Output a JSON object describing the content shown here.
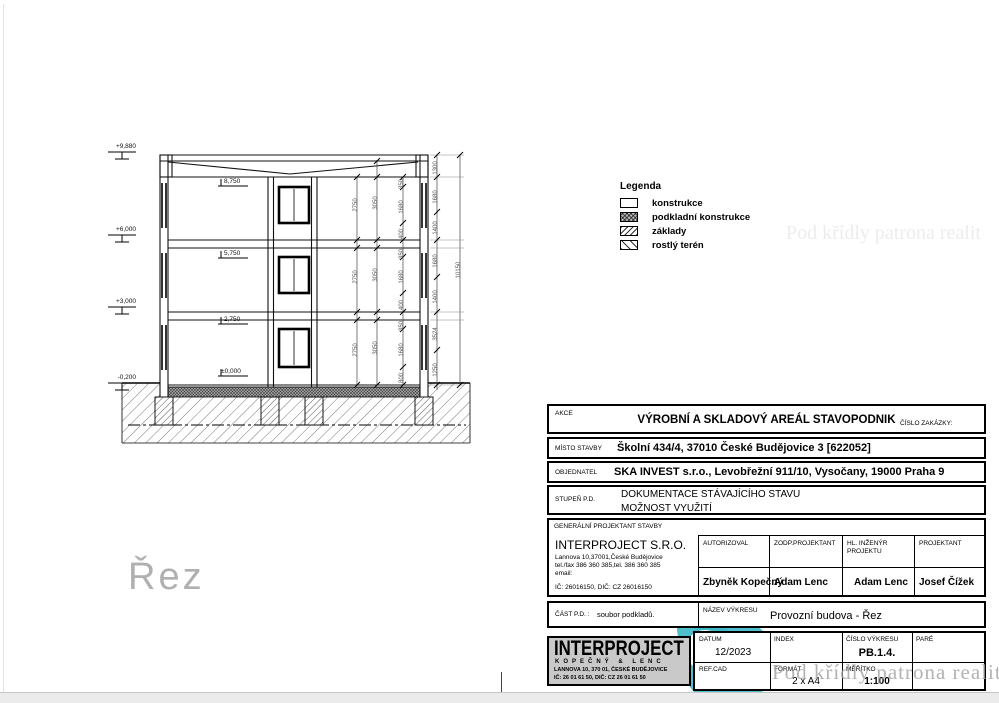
{
  "page": {
    "watermark": "Pod křídly patrona realit",
    "drawing_caption": "Řez"
  },
  "legend": {
    "title": "Legenda",
    "items": [
      {
        "label": "konstrukce"
      },
      {
        "label": "podkladní konstrukce"
      },
      {
        "label": "základy"
      },
      {
        "label": "rostlý terén"
      }
    ]
  },
  "drawing": {
    "levels_outer": [
      "+9,880",
      "+6,000",
      "+3,000",
      "-0,200"
    ],
    "levels_inner": [
      "8,750",
      "5,750",
      "2,750",
      "±0,000"
    ],
    "floor_heights": [
      "2750",
      "2750",
      "2750"
    ],
    "clear_heights": [
      "3050",
      "3050",
      "3050"
    ],
    "window_chain": [
      "350",
      "1680",
      "400",
      "350",
      "1680",
      "400",
      "350",
      "1680",
      "800"
    ],
    "right_chain": [
      "1300",
      "1680",
      "1400",
      "1680",
      "1400",
      "3524",
      "1250"
    ],
    "total_height": "10150"
  },
  "titleblock": {
    "akce_label": "AKCE",
    "akce_value": "VÝROBNÍ A SKLADOVÝ AREÁL STAVOPODNIK",
    "cislo_zakazky_label": "ČÍSLO ZAKÁZKY:",
    "misto_label": "MÍSTO STAVBY",
    "misto_value": "Školní 434/4, 37010 České Budějovice 3 [622052]",
    "objednatel_label": "OBJEDNATEL",
    "objednatel_value": "SKA INVEST s.r.o., Levobřežní 911/10, Vysočany, 19000 Praha 9",
    "stupen_label": "STUPEŇ P.D.",
    "stupen_value_1": "DOKUMENTACE STÁVAJÍCÍHO STAVU",
    "stupen_value_2": "MOŽNOST VYUŽITÍ",
    "gen_projektant_label": "GENERÁLNÍ PROJEKTANT STAVBY",
    "company": {
      "name": "INTERPROJECT S.R.O.",
      "address": "Lannova 10,37001,České Budějovice",
      "phone": "tel./fax 386 360 385,tel. 386 360 385",
      "email": "email:",
      "ic": "IČ: 26016150, DIČ: CZ 26016150"
    },
    "roles": [
      {
        "label": "AUTORIZOVAL",
        "name": "Zbyněk Kopečný"
      },
      {
        "label": "ZODP.PROJEKTANT",
        "name": "Adam Lenc"
      },
      {
        "label": "HL. INŽENÝR PROJEKTU",
        "name": "Adam Lenc"
      },
      {
        "label": "PROJEKTANT",
        "name": "Josef Čížek"
      }
    ],
    "cast_label": "ČÁST P.D. :",
    "cast_value": "soubor podkladů.",
    "nazev_label": "NÁZEV VÝKRESU",
    "nazev_value": "Provozní budova - Řez",
    "logo": {
      "line1": "INTERPROJECT",
      "line2": "KOPEČNÝ & LENC",
      "line3": "LANNOVA 10, 370 01, ČESKÉ BUDĚJOVICE",
      "line4": "IČ: 26 01 61 50,   DIČ: CZ 26 01 61 50"
    },
    "datum_label": "DATUM",
    "datum_value": "12/2023",
    "index_label": "INDEX",
    "cislo_vykresu_label": "ČÍSLO VÝKRESU",
    "cislo_vykresu_value": "PB.1.4.",
    "pare_label": "PARÉ",
    "refcad_label": "REF.CAD",
    "format_label": "FORMÁT",
    "format_value": "2 x A4",
    "meritko_label": "MĚŘÍTKO",
    "meritko_value": "1:100"
  }
}
